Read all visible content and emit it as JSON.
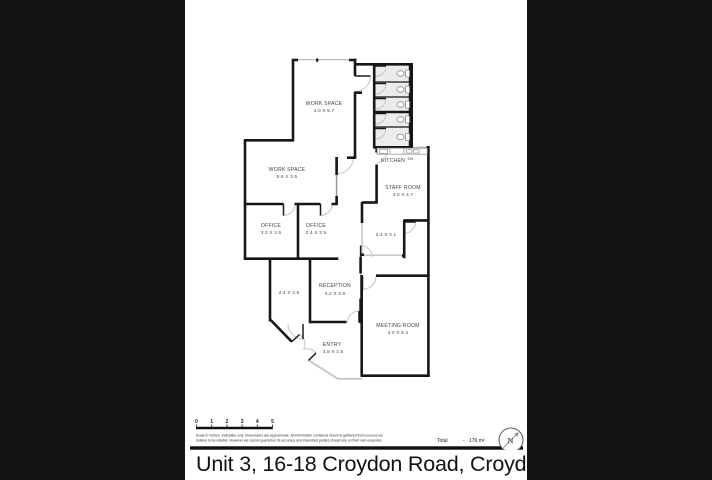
{
  "title": "Unit 3, 16-18 Croydon Road, Croydon",
  "colors": {
    "background": "#141414",
    "wall": "#161616",
    "window": "#b4b4b4",
    "door_arc": "#c9c9c9",
    "stall_floor": "#ececec",
    "label": "#3f3f3f"
  },
  "plan": {
    "rooms": [
      {
        "name": "WORK SPACE",
        "dims": "4.0 X 5.7"
      },
      {
        "name": "WORK SPACE",
        "dims": "5.6 X 3.6"
      },
      {
        "name": "OFFICE",
        "dims": "3.3 X 3.5"
      },
      {
        "name": "OFFICE",
        "dims": "2.4 X 3.5"
      },
      {
        "name": "KITCHEN",
        "dims": ""
      },
      {
        "name": "STAFF ROOM",
        "dims": "3.0 X 4.7"
      },
      {
        "name": "",
        "dims": "2.4 X 3.1"
      },
      {
        "name": "RECEPTION",
        "dims": "3.2 X 3.9"
      },
      {
        "name": "",
        "dims": "2.4 X 3.9"
      },
      {
        "name": "ENTRY",
        "dims": "3.5 X 3.5"
      },
      {
        "name": "MEETING ROOM",
        "dims": "4.0 X 6.4"
      }
    ],
    "appliances": {
      "dishwasher": "DW"
    }
  },
  "footer": {
    "scale_ticks": [
      "0",
      "1",
      "2",
      "3",
      "4",
      "5"
    ],
    "disclaimer_line1": "Scale in metres. Indicative only. Dimensions are approximate. All information contained herein is gathered from sources we",
    "disclaimer_line2": "believe to be reliable. However we cannot guarantee its accuracy and interested parties should rely on their own enquiries.",
    "total_label": "Total",
    "total_separator": "-",
    "total_value": "176 m²",
    "compass_label": "N"
  }
}
